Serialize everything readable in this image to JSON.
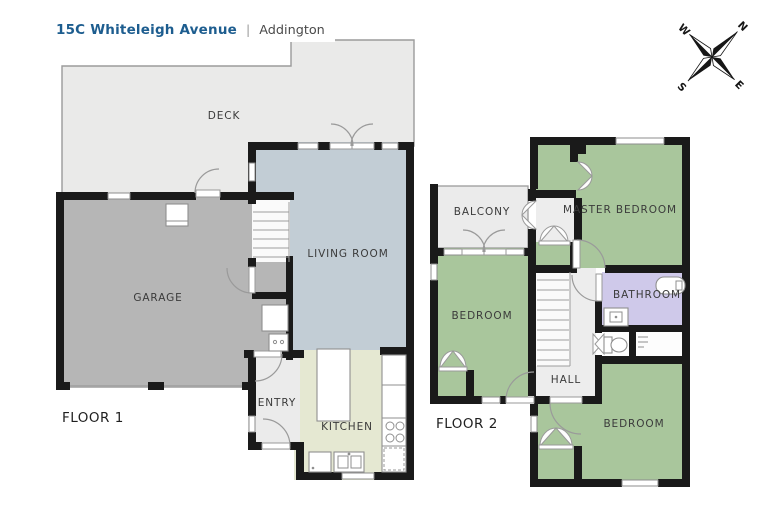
{
  "header": {
    "address": "15C Whiteleigh Avenue",
    "separator": "|",
    "suburb": "Addington"
  },
  "compass": {
    "n": "N",
    "e": "E",
    "s": "S",
    "w": "W"
  },
  "floor1": {
    "label": "FLOOR 1",
    "rooms": {
      "deck": "DECK",
      "garage": "GARAGE",
      "living": "LIVING ROOM",
      "entry": "ENTRY",
      "kitchen": "KITCHEN"
    }
  },
  "floor2": {
    "label": "FLOOR 2",
    "rooms": {
      "balcony": "BALCONY",
      "master": "MASTER BEDROOM",
      "bedroom_left": "BEDROOM",
      "bathroom": "BATHROOM",
      "hall": "HALL",
      "bedroom_right": "BEDROOM"
    }
  },
  "colors": {
    "wall": "#1a1a1a",
    "accent": "#1d5d8f",
    "deck": "#eaeae9",
    "garage": "#b6b6b6",
    "living": "#c2cdd5",
    "kitchen": "#e5e8d2",
    "entry": "#ebebeb",
    "bedroom": "#a9c69c",
    "bathroom": "#cfc9ea",
    "hall": "#ededed"
  }
}
